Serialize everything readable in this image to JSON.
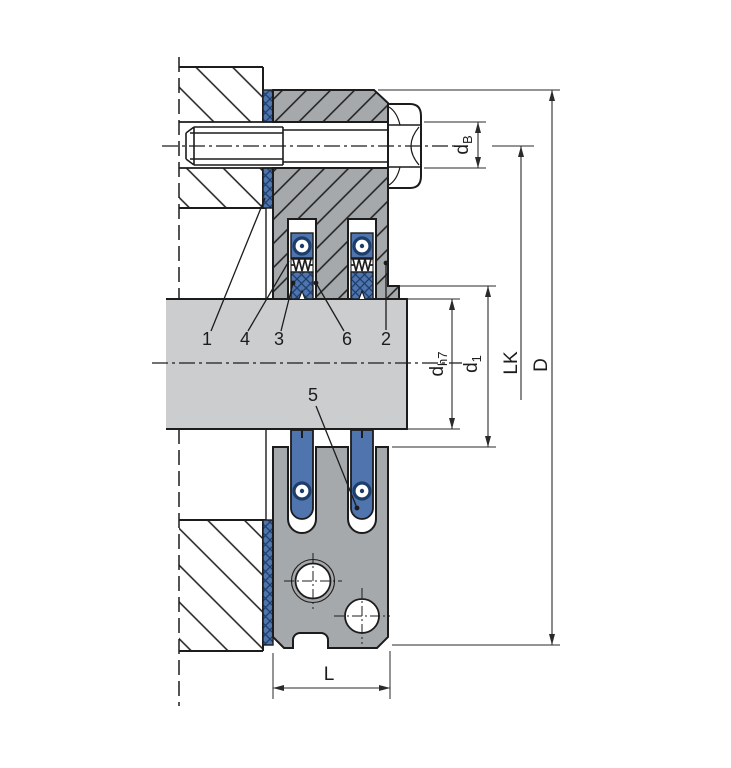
{
  "drawing": {
    "type": "technical-section-drawing",
    "description": "Cross-section of a flange-mounted shaft seal (gland with spring-loaded seal cartridges, gasket, hex bolt) on a housing wall",
    "callouts": {
      "item1": "1",
      "item4": "4",
      "item3": "3",
      "item6": "6",
      "item2": "2",
      "item5": "5"
    },
    "dimensions": {
      "bolt_hole_dia": {
        "main": "d",
        "sub": "B"
      },
      "shaft_dia": {
        "main": "d",
        "sub": "h7"
      },
      "bore_dia": {
        "main": "d",
        "sub": "1"
      },
      "bolt_circle": {
        "main": "LK",
        "sub": ""
      },
      "outer_dia": {
        "main": "D",
        "sub": ""
      },
      "width": {
        "main": "L",
        "sub": ""
      }
    },
    "colors": {
      "seal_blue": "#4f74ae",
      "seal_blue_dark": "#1d3d6b",
      "flange_gray": "#a6a9ab",
      "shaft_gray": "#cbcdcf",
      "line_black": "#1c1c1c",
      "dim_gray": "#2a2a2a",
      "background": "#ffffff"
    }
  }
}
